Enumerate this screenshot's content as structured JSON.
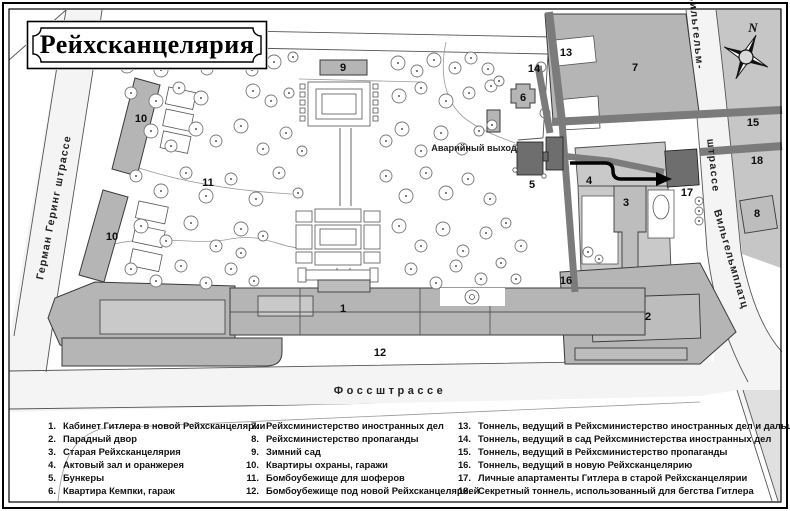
{
  "title": "Рейхсканцелярия",
  "colors": {
    "street_fill": "#f4f4f4",
    "block_east": "#c6c6c6",
    "building_fill": "#b5b5b5",
    "building_dark": "#6e6e6e",
    "tunnel": "#7b7b7b"
  },
  "map": {
    "compass_n": "N",
    "emergency_exit_label": "Аварийный выход",
    "streets": {
      "left": "Герман Геринг штрассе",
      "bottom": "Фоссштрассе",
      "right_top": "Вильгельм-",
      "right_mid": "штрассе",
      "right_bottom": "Вильгельмплатц"
    },
    "markers": [
      {
        "n": "1",
        "x": 343,
        "y": 312
      },
      {
        "n": "2",
        "x": 648,
        "y": 320
      },
      {
        "n": "3",
        "x": 626,
        "y": 206
      },
      {
        "n": "4",
        "x": 589,
        "y": 184
      },
      {
        "n": "5",
        "x": 532,
        "y": 188
      },
      {
        "n": "6",
        "x": 523,
        "y": 101
      },
      {
        "n": "7",
        "x": 635,
        "y": 71
      },
      {
        "n": "8",
        "x": 757,
        "y": 217
      },
      {
        "n": "9",
        "x": 343,
        "y": 71
      },
      {
        "n": "10",
        "x": 141,
        "y": 122
      },
      {
        "n": "10",
        "x": 112,
        "y": 240
      },
      {
        "n": "11",
        "x": 208,
        "y": 186
      },
      {
        "n": "12",
        "x": 380,
        "y": 356
      },
      {
        "n": "13",
        "x": 566,
        "y": 56
      },
      {
        "n": "14",
        "x": 534,
        "y": 72
      },
      {
        "n": "15",
        "x": 753,
        "y": 126
      },
      {
        "n": "16",
        "x": 566,
        "y": 284
      },
      {
        "n": "17",
        "x": 687,
        "y": 196
      },
      {
        "n": "18",
        "x": 757,
        "y": 164
      }
    ]
  },
  "legend": {
    "columns": [
      [
        {
          "num": "1.",
          "text": "Кабинет Гитлера в новой Рейхсканцелярии"
        },
        {
          "num": "2.",
          "text": "Парадный двор"
        },
        {
          "num": "3.",
          "text": "Старая Рейхсканцелярия"
        },
        {
          "num": "4.",
          "text": "Актовый зал и оранжерея"
        },
        {
          "num": "5.",
          "text": "Бункеры"
        },
        {
          "num": "6.",
          "text": "Квартира Кемпки, гараж"
        }
      ],
      [
        {
          "num": "7.",
          "text": "Рейхсминистерство иностранных дел"
        },
        {
          "num": "8.",
          "text": "Рейхсминистерство пропаганды"
        },
        {
          "num": "9.",
          "text": "Зимний сад"
        },
        {
          "num": "10.",
          "text": "Квартиры охраны, гаражи"
        },
        {
          "num": "11.",
          "text": "Бомбоубежище для шоферов"
        },
        {
          "num": "12.",
          "text": "Бомбоубежище под новой Рейхсканцелярией"
        }
      ],
      [
        {
          "num": "13.",
          "text": "Тоннель, ведущий в Рейхсминистерство иностранных дел и дальше"
        },
        {
          "num": "14.",
          "text": "Тоннель, ведущий в сад Рейхсминистерства иностранных дел"
        },
        {
          "num": "15.",
          "text": "Тоннель, ведущий в Рейхсминистерство пропаганды"
        },
        {
          "num": "16.",
          "text": "Тоннель, ведущий в новую Рейхсканцелярию"
        },
        {
          "num": "17.",
          "text": "Личные апартаменты Гитлера в старой Рейхсканцелярии"
        },
        {
          "num": "18.",
          "text": "Секретный тоннель, использованный для бегства Гитлера"
        }
      ]
    ]
  }
}
